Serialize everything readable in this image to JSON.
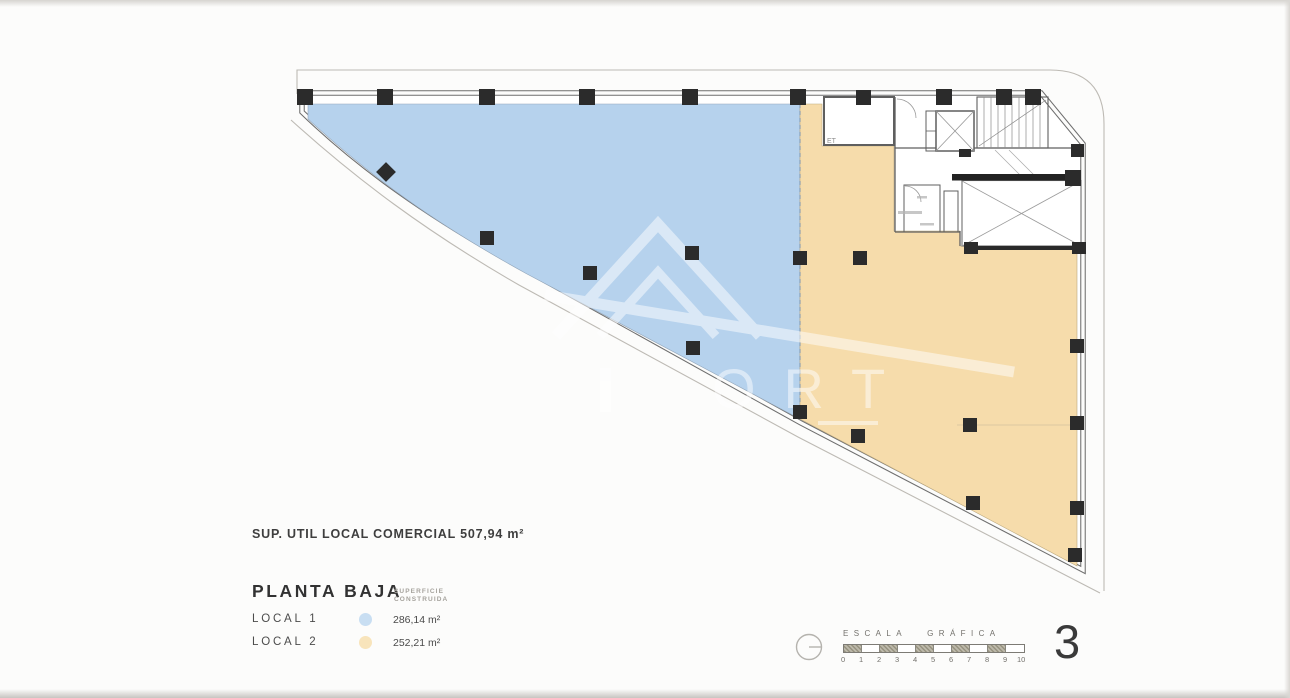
{
  "page": {
    "number": "3"
  },
  "plan": {
    "sup_util_label": "SUP. UTIL LOCAL COMERCIAL 507,94 m²",
    "room_label": "ET",
    "watermark_text": "ORT",
    "local1_color": "#b6d2ed",
    "local2_color": "#f6dcab"
  },
  "legend": {
    "heading": "PLANTA BAJA",
    "col_header_line1": "SUPERFICIE",
    "col_header_line2": "CONSTRUIDA",
    "items": [
      {
        "label": "LOCAL 1",
        "value": "286,14 m²",
        "color": "#c8def2"
      },
      {
        "label": "LOCAL 2",
        "value": "252,21 m²",
        "color": "#f8e4bb"
      }
    ]
  },
  "scale_bar": {
    "label": "ESCALA GRÁFICA",
    "ticks": [
      "0",
      "1",
      "2",
      "3",
      "4",
      "5",
      "6",
      "7",
      "8",
      "9",
      "10"
    ]
  }
}
